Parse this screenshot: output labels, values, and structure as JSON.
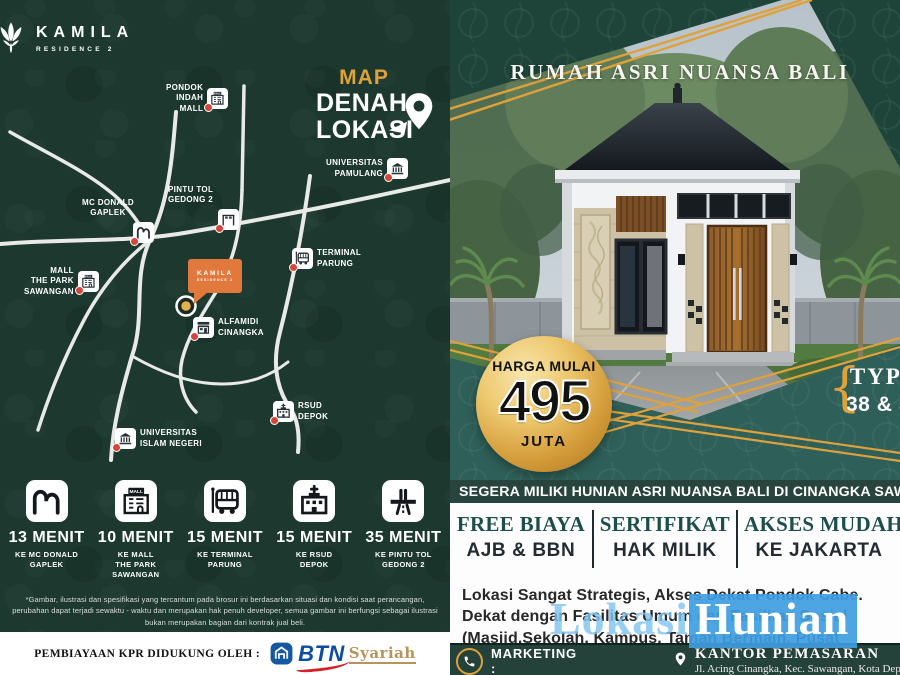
{
  "colors": {
    "dark_green": "#1C382F",
    "banner_green": "#1E443A",
    "teal_band": "#2E5F58",
    "gold_accent": "#DFA23B",
    "callout_orange": "#E2793C",
    "cta_bar_green": "#27453C",
    "feature_title_teal": "#1D4E4C",
    "watermark_blue": "#3F9DE2",
    "btn_blue": "#0C4DA2",
    "btn_red": "#D2232A",
    "btn_syariah_gold": "#B6955C"
  },
  "brand": {
    "name": "KAMILA",
    "subtitle": "RESIDENCE 2"
  },
  "left_panel": {
    "map_title": {
      "word1": "MAP",
      "word2": "DENAH",
      "word3": "LOKASI"
    },
    "landmarks": [
      {
        "label": "PONDOK\nINDAH\nMALL",
        "icon": "mall-icon"
      },
      {
        "label": "UNIVERSITAS\nPAMULANG",
        "icon": "university-icon"
      },
      {
        "label": "PINTU TOL\nGEDONG 2",
        "icon": "toll-gate-icon"
      },
      {
        "label": "MC DONALD\nGAPLEK",
        "icon": "mcdonalds-icon"
      },
      {
        "label": "TERMINAL\nPARUNG",
        "icon": "bus-icon"
      },
      {
        "label": "MALL\nTHE PARK\nSAWANGAN",
        "icon": "mall-icon"
      },
      {
        "label": "ALFAMIDI\nCINANGKA",
        "icon": "store-icon"
      },
      {
        "label": "RSUD\nDEPOK",
        "icon": "hospital-icon"
      },
      {
        "label": "UNIVERSITAS\nISLAM NEGERI",
        "icon": "university-icon"
      }
    ],
    "map_callout": {
      "name": "KAMILA",
      "subtitle": "RESIDENCE 2"
    },
    "travel_times": [
      {
        "time": "13 MENIT",
        "destination": "KE MC DONALD\nGAPLEK",
        "icon": "mcdonalds-icon"
      },
      {
        "time": "10 MENIT",
        "destination": "KE MALL\nTHE PARK\nSAWANGAN",
        "icon": "mall-icon",
        "icon_text": "MALL"
      },
      {
        "time": "15 MENIT",
        "destination": "KE TERMINAL\nPARUNG",
        "icon": "bus-icon"
      },
      {
        "time": "15 MENIT",
        "destination": "KE RSUD\nDEPOK",
        "icon": "hospital-icon"
      },
      {
        "time": "35 MENIT",
        "destination": "KE PINTU TOL\nGEDONG 2",
        "icon": "highway-icon"
      }
    ],
    "disclaimer": "*Gambar, ilustrasi dan spesifikasi yang tercantum pada brosur ini berdasarkan situasi dan kondisi saat perancangan, perubahan dapat terjadi sewaktu - waktu dan merupakan hak penuh developer, semua gambar ini berfungsi sebagai ilustrasi bukan merupakan bagian dari kontrak jual beli.",
    "financing": {
      "label": "PEMBIAYAAN KPR DIDUKUNG OLEH :",
      "bank_name": "BTN",
      "bank_suffix": "Syariah"
    }
  },
  "right_panel": {
    "tagline": "RUMAH ASRI NUANSA BALI",
    "price_badge": {
      "prefix": "HARGA MULAI",
      "value": "495",
      "suffix": "JUTA"
    },
    "type_label": {
      "brace": "{",
      "line1": "TYPE",
      "line2": "38 & 56"
    },
    "cta": "SEGERA MILIKI HUNIAN ASRI NUANSA BALI DI CINANGKA SAWANGAN",
    "features": [
      {
        "title": "FREE BIAYA",
        "subtitle": "AJB & BBN"
      },
      {
        "title": "SERTIFIKAT",
        "subtitle": "HAK MILIK"
      },
      {
        "title": "AKSES MUDAH",
        "subtitle": "KE JAKARTA"
      }
    ],
    "location_text": "Lokasi Sangat Strategis, Akses Dekat Pondok Cabe. Dekat dengan Fasilitas Umum dan Fasilitas Sosial (Masjid,Sekolah, Kampus, Taman Bermain, Pusat Perbelanjaan, Rumah Sakit dll).",
    "watermark": {
      "part1": "Lokasi",
      "part2": "Hunian"
    },
    "marketing": {
      "label": "MARKETING :",
      "office": "KANTOR PEMASARAN",
      "address": "Jl. Acing Cinangka, Kec. Sawangan, Kota Depok"
    }
  }
}
